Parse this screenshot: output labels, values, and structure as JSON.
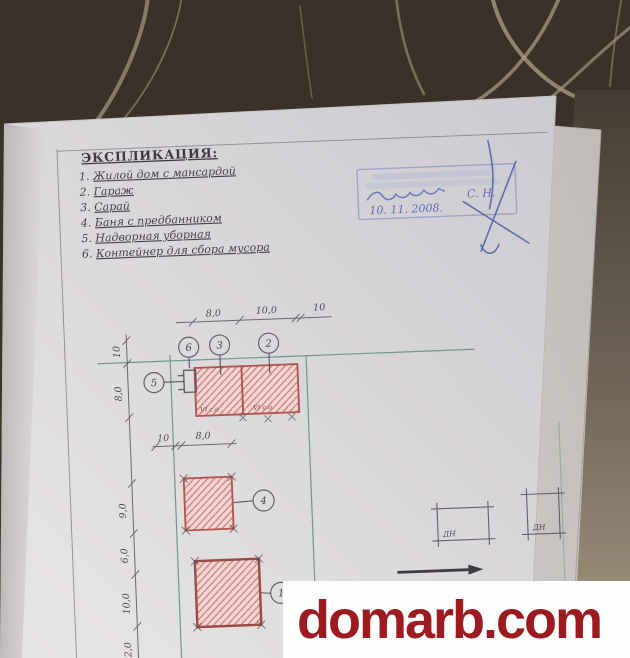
{
  "watermark": {
    "text": "domarb.com"
  },
  "explication": {
    "title": "ЭКСПЛИКАЦИЯ:",
    "items": [
      {
        "num": "1.",
        "label": "Жилой дом с мансардой"
      },
      {
        "num": "2.",
        "label": "Гараж"
      },
      {
        "num": "3.",
        "label": "Сарай"
      },
      {
        "num": "4.",
        "label": "Баня с предбанником"
      },
      {
        "num": "5.",
        "label": "Надворная уборная"
      },
      {
        "num": "6.",
        "label": "Контейнер для сбора мусора"
      }
    ]
  },
  "stamp": {
    "initials": "С. Н.",
    "date": "10. 11. 2008."
  },
  "plan": {
    "dims_top": [
      "8,0",
      "10,0",
      "10"
    ],
    "dims_left": [
      "10",
      "8,0",
      "9,0",
      "6,0",
      "10,0",
      "2,0"
    ],
    "dims_mid": [
      "10",
      "8,0"
    ],
    "callouts": {
      "house": "1",
      "garage": "2",
      "shed": "3",
      "bath": "4",
      "latrine": "5",
      "container": "6"
    },
    "marks": [
      "VI с.о",
      "VI с.о"
    ],
    "dn": [
      "ДН",
      "ДН"
    ]
  },
  "colors": {
    "background": "#3a3128",
    "streak": "#a3947b",
    "paper": "#dad7da",
    "pencil": "#4f4b56",
    "teal_line": "#5e8b81",
    "building_border": "#b0544e",
    "building_hatch": "#cc7a73",
    "building_fill": "#f0d6d4",
    "stamp_blue": "#8d99c6",
    "pen_blue": "#4a5ea6",
    "watermark_red": "#9b1b20"
  }
}
